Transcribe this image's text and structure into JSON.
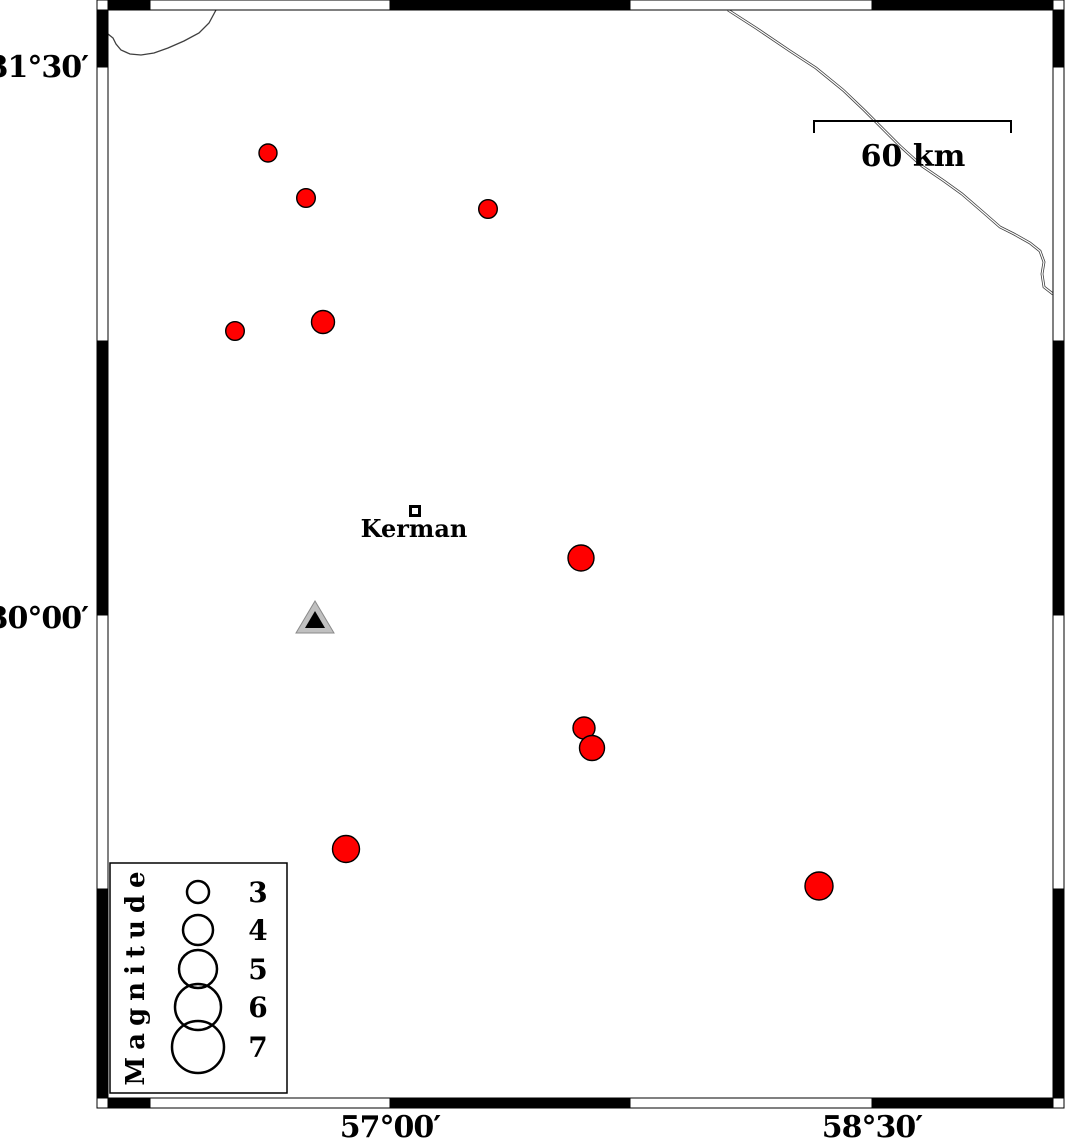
{
  "map": {
    "region_name": "Kerman seismicity map",
    "frame": {
      "outer": {
        "x": 97,
        "y": 0,
        "w": 967,
        "h": 1108
      },
      "bar_thickness_h": 10,
      "bar_thickness_v": 11,
      "x_ticks_px": [
        108,
        150,
        390,
        630,
        872,
        1053
      ],
      "y_ticks_px": [
        10,
        67,
        341,
        615,
        889,
        1098
      ],
      "tick_interval": "45 arc-minutes"
    },
    "axes": {
      "left_labels": [
        {
          "text": "31°30′",
          "x": 88,
          "y": 77,
          "lat_px": 67
        },
        {
          "text": "30°00′",
          "x": 88,
          "y": 628,
          "lat_px": 615
        }
      ],
      "bottom_labels": [
        {
          "text": "57°00′",
          "x": 390,
          "y": 1137,
          "lon_px": 390
        },
        {
          "text": "58°30′",
          "x": 872,
          "y": 1137,
          "lon_px": 872
        }
      ]
    },
    "scale_bar": {
      "label": "60 km",
      "x1": 814,
      "x2": 1011,
      "y": 121,
      "tick_drop": 12,
      "label_x": 913,
      "label_y": 166
    },
    "city": {
      "label": "Kerman",
      "marker": {
        "x": 409,
        "y": 505,
        "size": 12
      },
      "label_x": 414,
      "label_y": 537,
      "approx_lon": 57.08,
      "approx_lat": 30.28
    },
    "station": {
      "outer_points": "315,601 296,633 334,633",
      "inner_points": "315,611 305,628 325,628",
      "approx_lon": 56.77,
      "approx_lat": 29.99
    },
    "legend": {
      "title": "Magnitude",
      "box": {
        "x": 110,
        "y": 863,
        "w": 177,
        "h": 230
      },
      "circle_cx": 198,
      "number_x": 258,
      "entries": [
        {
          "mag": "3",
          "cy": 892,
          "r": 11
        },
        {
          "mag": "4",
          "cy": 930,
          "r": 15
        },
        {
          "mag": "5",
          "cy": 969,
          "r": 19
        },
        {
          "mag": "6",
          "cy": 1007,
          "r": 23
        },
        {
          "mag": "7",
          "cy": 1047,
          "r": 26
        }
      ]
    },
    "earthquakes": [
      {
        "x": 268,
        "y": 153,
        "r": 9,
        "approx_lon": 56.62,
        "approx_lat": 31.26
      },
      {
        "x": 306,
        "y": 198,
        "r": 9.3,
        "approx_lon": 56.74,
        "approx_lat": 31.14
      },
      {
        "x": 488,
        "y": 209,
        "r": 9.3,
        "approx_lon": 57.31,
        "approx_lat": 31.11
      },
      {
        "x": 235,
        "y": 331,
        "r": 9.3,
        "approx_lon": 56.52,
        "approx_lat": 30.78
      },
      {
        "x": 323,
        "y": 322,
        "r": 11.5,
        "approx_lon": 56.79,
        "approx_lat": 30.8
      },
      {
        "x": 581,
        "y": 558,
        "r": 13,
        "approx_lon": 57.6,
        "approx_lat": 30.16
      },
      {
        "x": 584,
        "y": 728,
        "r": 11,
        "approx_lon": 57.6,
        "approx_lat": 29.69
      },
      {
        "x": 592,
        "y": 748,
        "r": 12.5,
        "approx_lon": 57.63,
        "approx_lat": 29.64
      },
      {
        "x": 346,
        "y": 849,
        "r": 13.5,
        "approx_lon": 56.86,
        "approx_lat": 29.36
      },
      {
        "x": 819,
        "y": 886,
        "r": 14,
        "approx_lon": 58.34,
        "approx_lat": 29.26
      }
    ],
    "roads": [
      {
        "id": "road-northwest",
        "double_line": false,
        "points": "108,34 113,38 116,44 121,50 130,54 141,55 154,53 168,48 184,41 199,33 209,23 216,10"
      },
      {
        "id": "road-northeast",
        "double_line": true,
        "points": "728,10 756,28 790,51 816,68 843,90 864,110 880,126 900,146 922,166 944,181 962,194 984,213 1000,227 1014,234 1030,243 1040,251 1044,262 1042,274 1044,287 1053,294"
      }
    ],
    "colors": {
      "epicenter_fill": "#ff0000",
      "outline": "#000000",
      "station_fill": "#c0c0c0",
      "station_edge": "#8a8a8a",
      "road": "#3f3f3f",
      "frame_black": "#000000",
      "frame_white": "#ffffff",
      "background": "#ffffff"
    }
  }
}
